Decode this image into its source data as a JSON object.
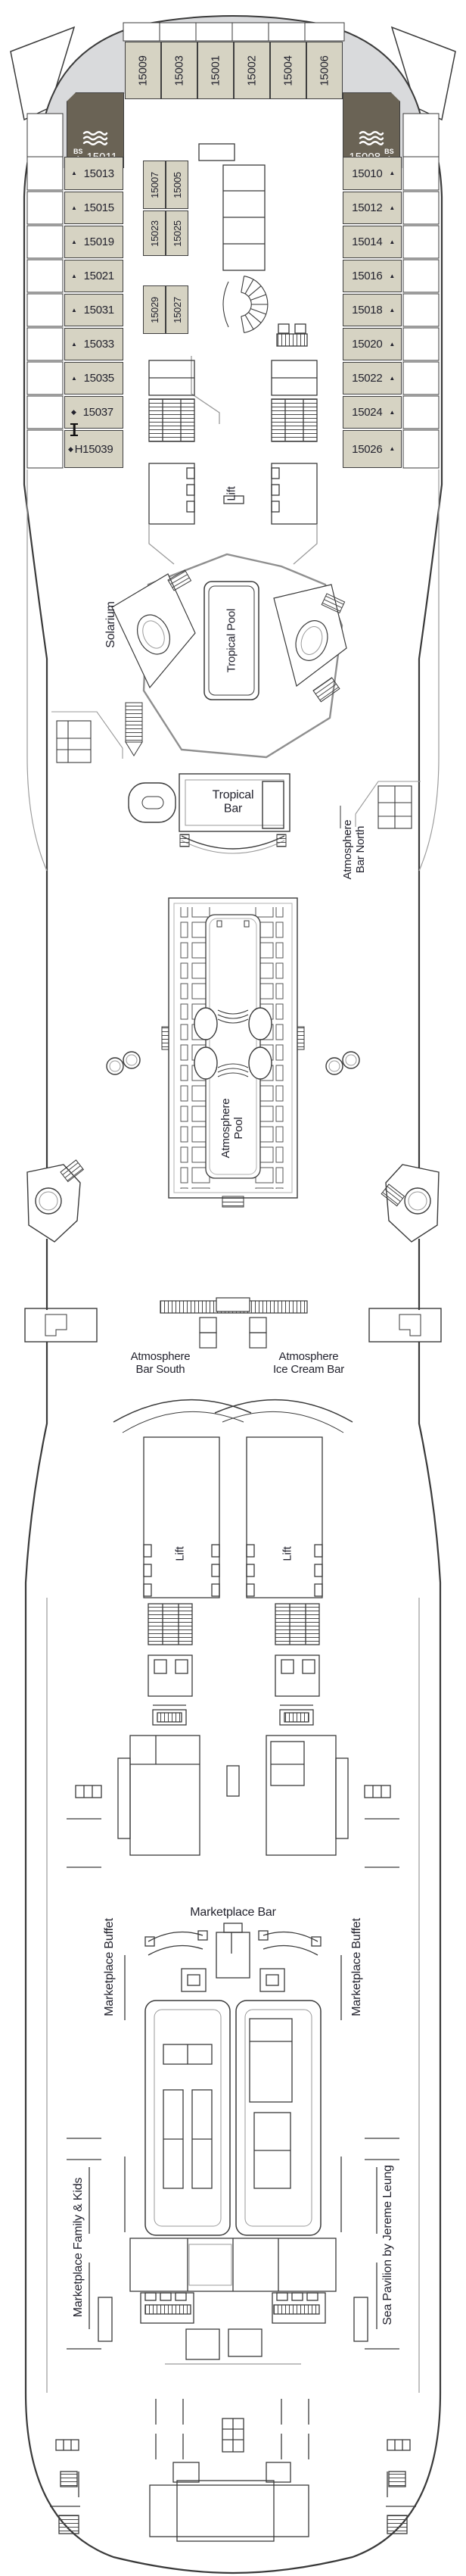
{
  "plan_title": "Deck 15 deck plan",
  "palette": {
    "cabin_fill": "#d6d3c3",
    "suite_fill": "#6a6355",
    "bow_deck_fill": "#d9dadc",
    "line": "#3a3a3a",
    "text": "#23232e"
  },
  "suites": {
    "port": {
      "number": "15011",
      "badge": "BS",
      "badge_icon": "◆",
      "waves_icon": "waves"
    },
    "starboard": {
      "number": "15008",
      "badge": "BS",
      "badge_icon": "◆",
      "waves_icon": "waves"
    }
  },
  "cabins": {
    "bow": [
      "15009",
      "15003",
      "15001",
      "15002",
      "15004",
      "15006"
    ],
    "port": [
      {
        "n": "15013",
        "m": "▲"
      },
      {
        "n": "15015",
        "m": "▲"
      },
      {
        "n": "15019",
        "m": "▲"
      },
      {
        "n": "15021",
        "m": "▲"
      },
      {
        "n": "15031",
        "m": "▲"
      },
      {
        "n": "15033",
        "m": "▲"
      },
      {
        "n": "15035",
        "m": "▲"
      },
      {
        "n": "15037",
        "m": "◆"
      },
      {
        "n": "H15039",
        "m": "◆"
      }
    ],
    "starboard": [
      {
        "n": "15010",
        "m": "▲"
      },
      {
        "n": "15012",
        "m": "▲"
      },
      {
        "n": "15014",
        "m": "▲"
      },
      {
        "n": "15016",
        "m": "▲"
      },
      {
        "n": "15018",
        "m": "▲"
      },
      {
        "n": "15020",
        "m": "▲"
      },
      {
        "n": "15022",
        "m": "▲"
      },
      {
        "n": "15024",
        "m": "▲"
      },
      {
        "n": "15026",
        "m": "▲"
      }
    ],
    "mid": [
      "15007",
      "15005",
      "15023",
      "15025",
      "15029",
      "15027"
    ]
  },
  "labels": {
    "solarium": "Solarium",
    "tropical_pool": "Tropical Pool",
    "tropical_bar_1": "Tropical",
    "tropical_bar_2": "Bar",
    "atmosphere_bar_north_1": "Atmosphere",
    "atmosphere_bar_north_2": "Bar North",
    "atmosphere_pool_1": "Atmosphere",
    "atmosphere_pool_2": "Pool",
    "atmosphere_bar_south_1": "Atmosphere",
    "atmosphere_bar_south_2": "Bar South",
    "ice_cream_bar_1": "Atmosphere",
    "ice_cream_bar_2": "Ice Cream Bar",
    "lift": "Lift",
    "marketplace_bar": "Marketplace Bar",
    "marketplace_buffet": "Marketplace Buffet",
    "marketplace_family_kids": "Marketplace Family & Kids",
    "sea_pavilion": "Sea Pavilion by Jereme Leung"
  }
}
